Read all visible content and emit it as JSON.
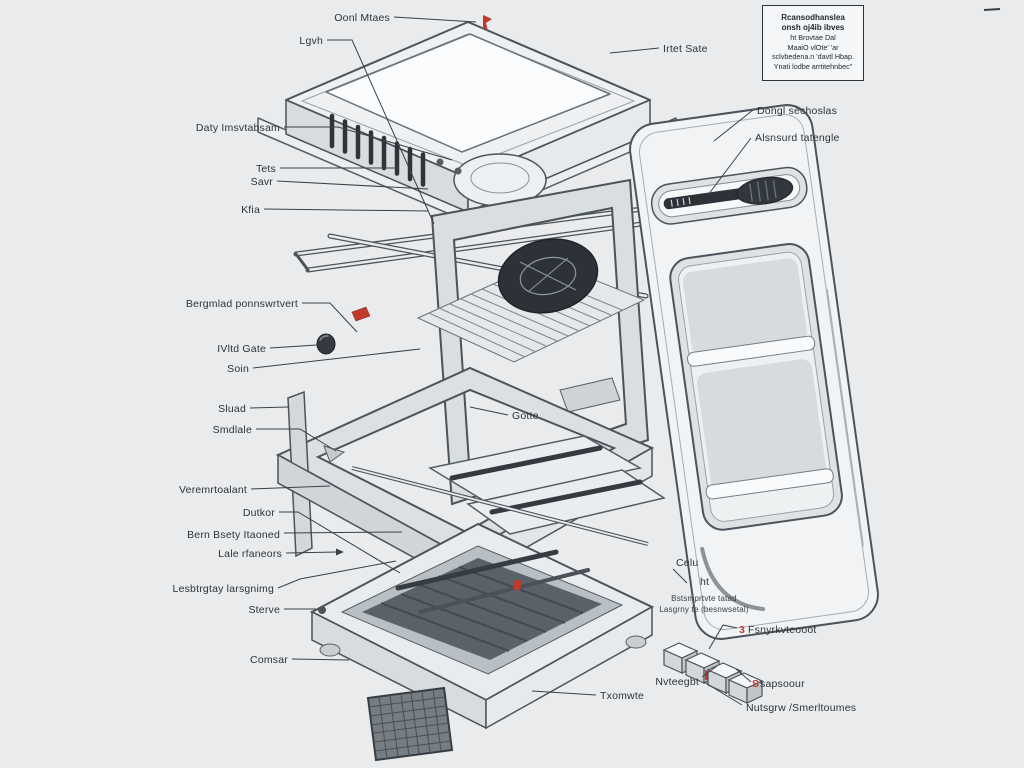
{
  "colors": {
    "background": "#e9ebec",
    "line": "#4c535a",
    "dark_detail": "#2c3237",
    "accent_red": "#c0392b",
    "panel_fill": "#f1f3f4"
  },
  "note_box": {
    "bold": [
      "Rcansodhanslea",
      "onsh oj4ib ibves"
    ],
    "lines": [
      "ht Brovtae Dal",
      "MaaiO vlOte' 'ar",
      "sclvbedena.n 'davtl Hbap.",
      "Ynati lodbe arrtitehnbec\""
    ]
  },
  "labels": [
    {
      "text": "Oonl Mtaes"
    },
    {
      "text": "Lgvh"
    },
    {
      "text": "Daty Imsvtabsam"
    },
    {
      "text": "Tets"
    },
    {
      "text": "Savr"
    },
    {
      "text": "Kfia"
    },
    {
      "text": "Bergmlad ponnswrtvert"
    },
    {
      "text": "IVltd Gate"
    },
    {
      "text": "Soin"
    },
    {
      "text": "Sluad"
    },
    {
      "text": "Smdlale"
    },
    {
      "text": "Veremrtoalant"
    },
    {
      "text": "Dutkor"
    },
    {
      "text": "Bern Bsety Itaoned"
    },
    {
      "text": "Lale rfaneors"
    },
    {
      "text": "Lesbtrgtay larsgnimg"
    },
    {
      "text": "Sterve"
    },
    {
      "text": "Comsar"
    },
    {
      "text": "Txomwte"
    },
    {
      "text": "Irtet Sate"
    },
    {
      "text": "Dongl sechoslas"
    },
    {
      "text": "Alsnsurd tatengle"
    },
    {
      "text": "Gotte"
    },
    {
      "text": "Celu"
    },
    {
      "text": "ht"
    },
    {
      "line1": "Bstsmprtvte tatad",
      "line2": "Lasgrny te (besnwsetal)"
    },
    {
      "red_prefix": "3",
      "text": "Fsnyrkvteooot"
    },
    {
      "text": "Nvteegbt"
    },
    {
      "red_prefix": "S",
      "text": "sapsoour"
    },
    {
      "text": "Nutsgrw /Smerltoumes"
    }
  ]
}
